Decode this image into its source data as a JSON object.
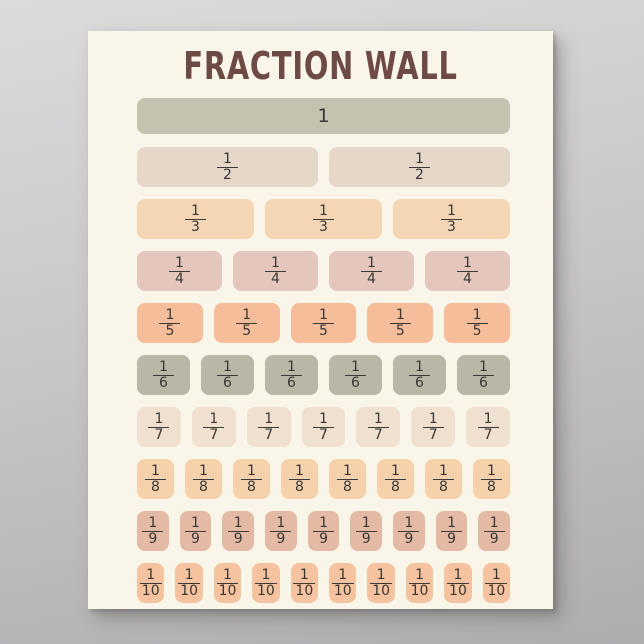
{
  "title": "FRACTION WALL",
  "colors": {
    "wall_background_top": "#dcdadb",
    "wall_background_bottom": "#aeacad",
    "poster_background": "#f9f5e8",
    "title_text": "#6e4a45",
    "fraction_text": "#393734",
    "fraction_bar_line": "#3c3936"
  },
  "rows": [
    {
      "kind": "whole",
      "label": "1",
      "numerator": "1",
      "denominator": "",
      "count": 1,
      "color": "#c5c2b0"
    },
    {
      "kind": "fraction",
      "label": "1/2",
      "numerator": "1",
      "denominator": "2",
      "count": 2,
      "color": "#e6d8c9"
    },
    {
      "kind": "fraction",
      "label": "1/3",
      "numerator": "1",
      "denominator": "3",
      "count": 3,
      "color": "#f4d5b4"
    },
    {
      "kind": "fraction",
      "label": "1/4",
      "numerator": "1",
      "denominator": "4",
      "count": 4,
      "color": "#e4c6bc"
    },
    {
      "kind": "fraction",
      "label": "1/5",
      "numerator": "1",
      "denominator": "5",
      "count": 5,
      "color": "#f6bd9b"
    },
    {
      "kind": "fraction",
      "label": "1/6",
      "numerator": "1",
      "denominator": "6",
      "count": 6,
      "color": "#bab7a7"
    },
    {
      "kind": "fraction",
      "label": "1/7",
      "numerator": "1",
      "denominator": "7",
      "count": 7,
      "color": "#efe0d0"
    },
    {
      "kind": "fraction",
      "label": "1/8",
      "numerator": "1",
      "denominator": "8",
      "count": 8,
      "color": "#f5d2ab"
    },
    {
      "kind": "fraction",
      "label": "1/9",
      "numerator": "1",
      "denominator": "9",
      "count": 9,
      "color": "#e4baa5"
    },
    {
      "kind": "fraction",
      "label": "1/10",
      "numerator": "1",
      "denominator": "10",
      "count": 10,
      "color": "#f6c3a0"
    }
  ]
}
